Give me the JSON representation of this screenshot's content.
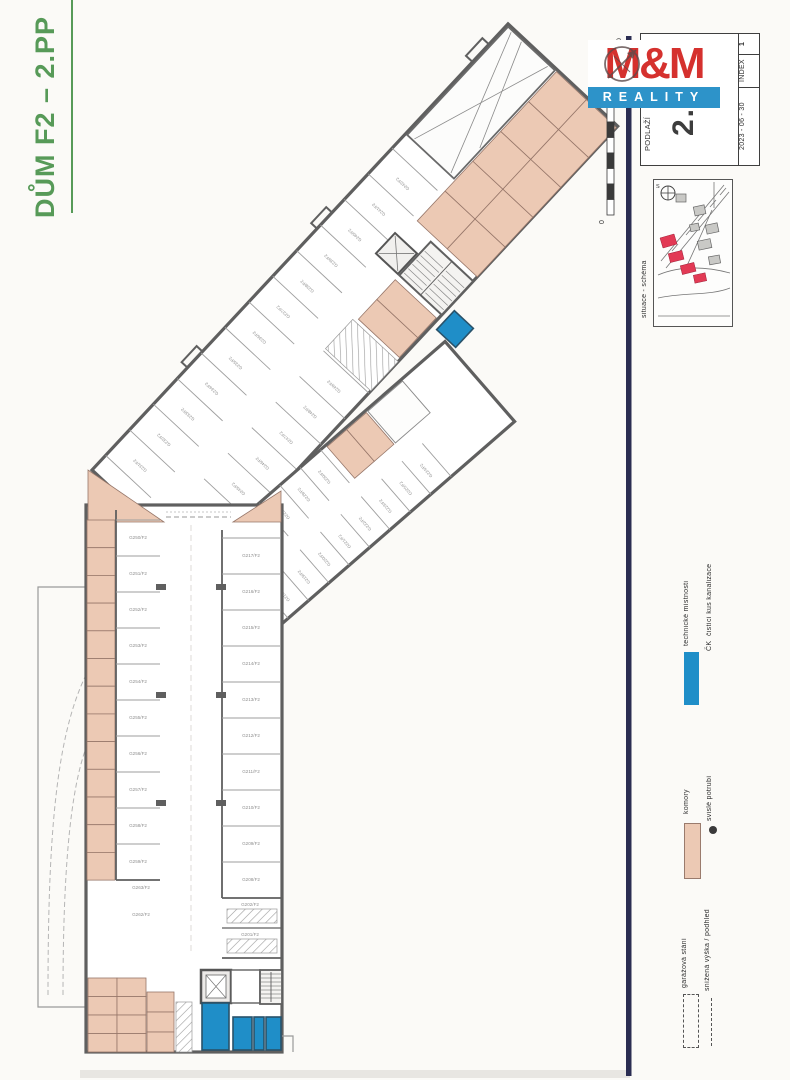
{
  "colors": {
    "green": "#579a58",
    "navy": "#2b2d52",
    "logo_red": "#d5312e",
    "logo_blue": "#2d93c9",
    "tech_blue": "#1f8ec8",
    "komory_pink": "#ecc9b4",
    "map_red": "#e23a55"
  },
  "title": {
    "text": "DŮM F2 – 2.PP"
  },
  "logo": {
    "line1": "M&M",
    "line2": "REALITY"
  },
  "titleblock": {
    "floor_label": "PODLAŽÍ",
    "floor_value": "2.PP",
    "date": "2023 - 06 - 30",
    "index_label": "INDEX",
    "index_value": "1"
  },
  "scalebar": {
    "zero": "0",
    "ratio": "1 : 200"
  },
  "sitemap": {
    "caption": "situace - schéma",
    "north": "S"
  },
  "legend": {
    "technical": {
      "label": "technické místnosti",
      "abbr": "ČK",
      "abbr_desc": "čistící kus kanalizace"
    },
    "komory": {
      "label": "komory",
      "marker_desc": "svislé potrubí"
    },
    "garage": {
      "label": "garážová stání",
      "line_desc": "snížená výška / podhled"
    }
  },
  "plan": {
    "stalls": {
      "left_column": [
        "G250/F2",
        "G251/F2",
        "G252/F2",
        "G253/F2",
        "G254/F2",
        "G255/F2",
        "G256/F2",
        "G257/F2",
        "G258/F2",
        "G259/F2"
      ],
      "right_column": [
        "G217/F2",
        "G216/F2",
        "G215/F2",
        "G214/F2",
        "G213/F2",
        "G212/F2",
        "G211/F2",
        "G210/F2",
        "G209/F2",
        "G208/F2"
      ],
      "band1_top": [
        "G231/F2",
        "G232/F2",
        "G233/F2",
        "G234/F2",
        "G235/F2",
        "G236/F2",
        "G237/F2",
        "G238/F2",
        "G239/F2",
        "G240/F2",
        "G241/F2",
        "G242/F2"
      ],
      "band1_bottom": [
        "G243/F2",
        "G244/F2",
        "G245/F2",
        "G246/F2",
        "G247/F2",
        "G248/F2",
        "G249/F2"
      ],
      "band2_top": [
        "G226/F2",
        "G227/F2",
        "G228/F2",
        "G229/F2",
        "G230/F2"
      ],
      "band2_bottom": [
        "G218/F2",
        "G219/F2",
        "G220/F2",
        "G221/F2",
        "G222/F2",
        "G223/F2",
        "G225/F2",
        "G224/F2"
      ],
      "rooms": [
        "G263/F2",
        "G262/F2",
        "G202/F2",
        "G201/F2"
      ]
    }
  }
}
